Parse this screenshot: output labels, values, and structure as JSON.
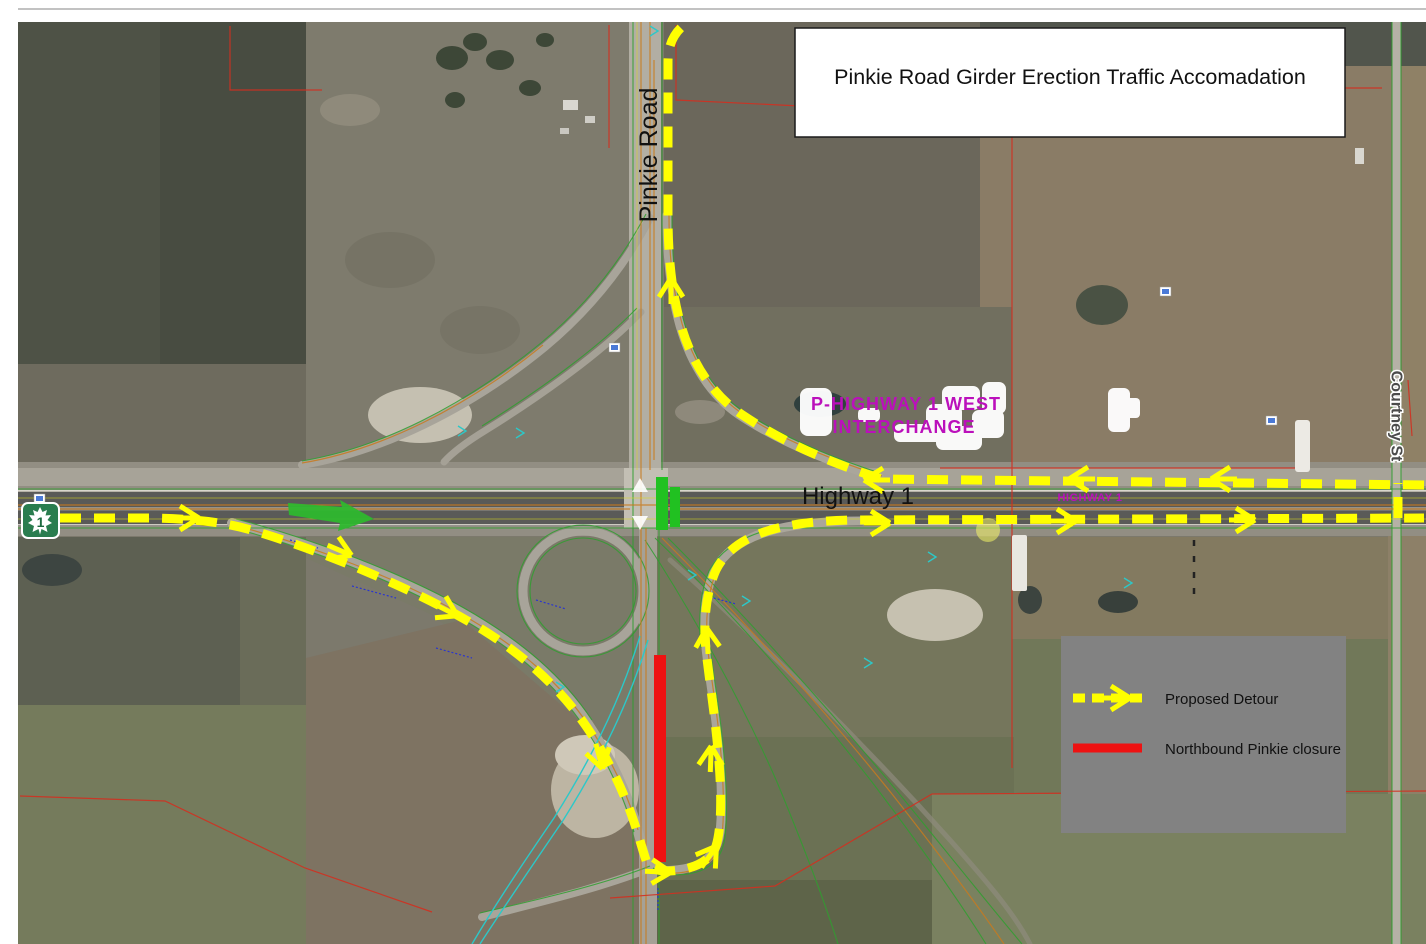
{
  "title": "Pinkie Road Girder Erection Traffic Accomadation",
  "legend": {
    "proposed_detour": "Proposed Detour",
    "closure": "Northbound Pinkie closure"
  },
  "labels": {
    "pinkie_road": "Pinkie Road",
    "highway_1": "Highway 1",
    "highway_1_small": "HIGHWAY 1",
    "courtney_st": "Courtney St",
    "interchange_line1": "P-HIGHWAY 1 WEST",
    "interchange_line2": "INTERCHANGE",
    "shield_number": "1"
  },
  "colors": {
    "detour_yellow": "#ffff00",
    "closure_red": "#ee1212",
    "legend_bg": "#828282",
    "bridge_marker_green": "#21c121",
    "merge_arrow_green": "#2eb82e",
    "interchange_magenta": "#bb10bb",
    "shield_green": "#2a7d4f"
  }
}
